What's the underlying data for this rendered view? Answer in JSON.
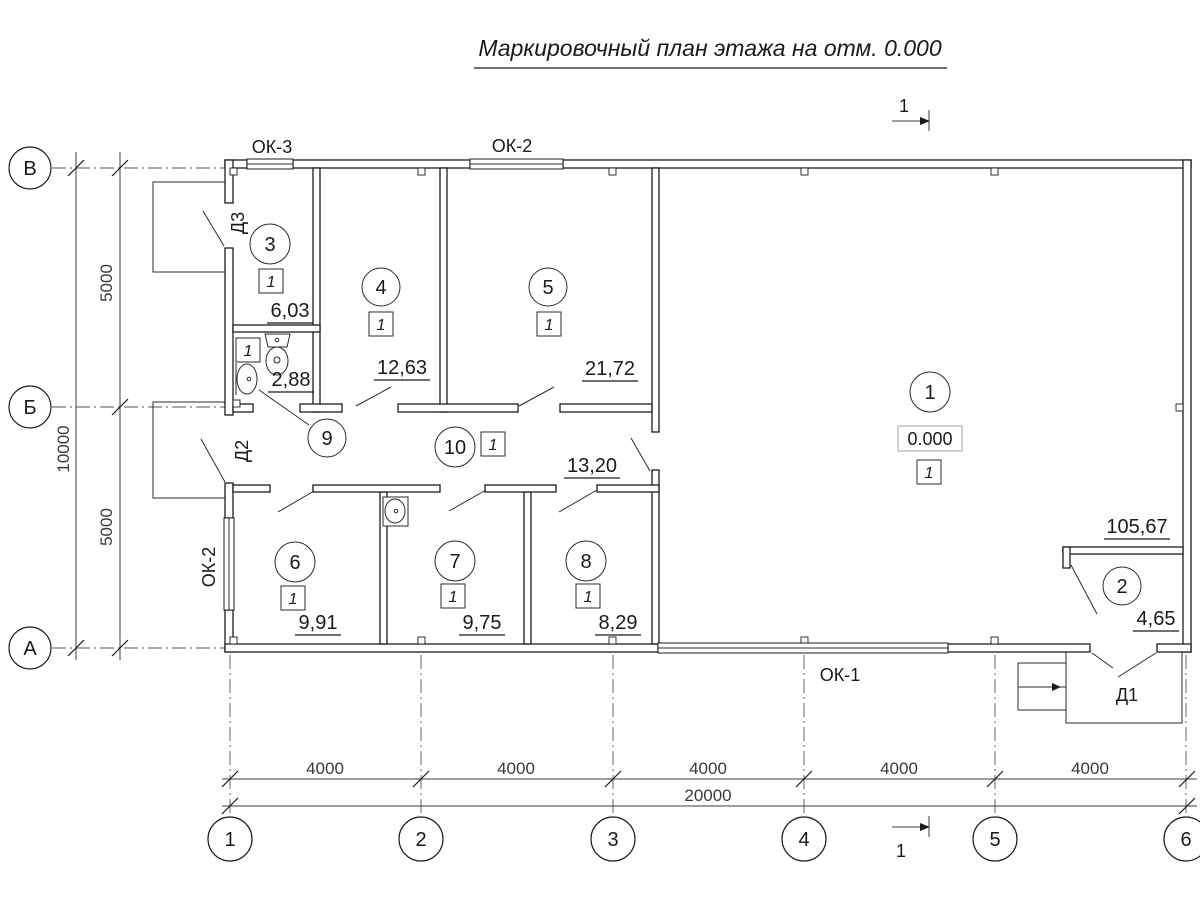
{
  "title": "Маркировочный план этажа на отм. 0.000",
  "section_mark_label": "1",
  "elevation": "0.000",
  "axes": {
    "rows": [
      "В",
      "Б",
      "А"
    ],
    "cols": [
      "1",
      "2",
      "3",
      "4",
      "5",
      "6"
    ]
  },
  "dimensions": {
    "left": {
      "spans": [
        "5000",
        "5000"
      ],
      "total": "10000"
    },
    "bottom": {
      "spans": [
        "4000",
        "4000",
        "4000",
        "4000",
        "4000"
      ],
      "total": "20000"
    }
  },
  "rooms": [
    {
      "number": "1",
      "area": "105,67",
      "floor_type": "1"
    },
    {
      "number": "2",
      "area": "4,65"
    },
    {
      "number": "3",
      "area": "6,03",
      "floor_type": "1"
    },
    {
      "number": "4",
      "area": "12,63",
      "floor_type": "1"
    },
    {
      "number": "5",
      "area": "21,72",
      "floor_type": "1"
    },
    {
      "number": "6",
      "area": "9,91",
      "floor_type": "1"
    },
    {
      "number": "7",
      "area": "9,75",
      "floor_type": "1"
    },
    {
      "number": "8",
      "area": "8,29",
      "floor_type": "1"
    },
    {
      "number": "9",
      "area": "2,88",
      "floor_type": "1"
    },
    {
      "number": "10",
      "area": "13,20",
      "floor_type": "1"
    }
  ],
  "windows": {
    "ok3": "ОК-3",
    "ok2_top": "ОК-2",
    "ok2_left": "ОК-2",
    "ok1": "ОК-1"
  },
  "doors": {
    "d1": "Д1",
    "d2": "Д2",
    "d3": "Д3"
  }
}
